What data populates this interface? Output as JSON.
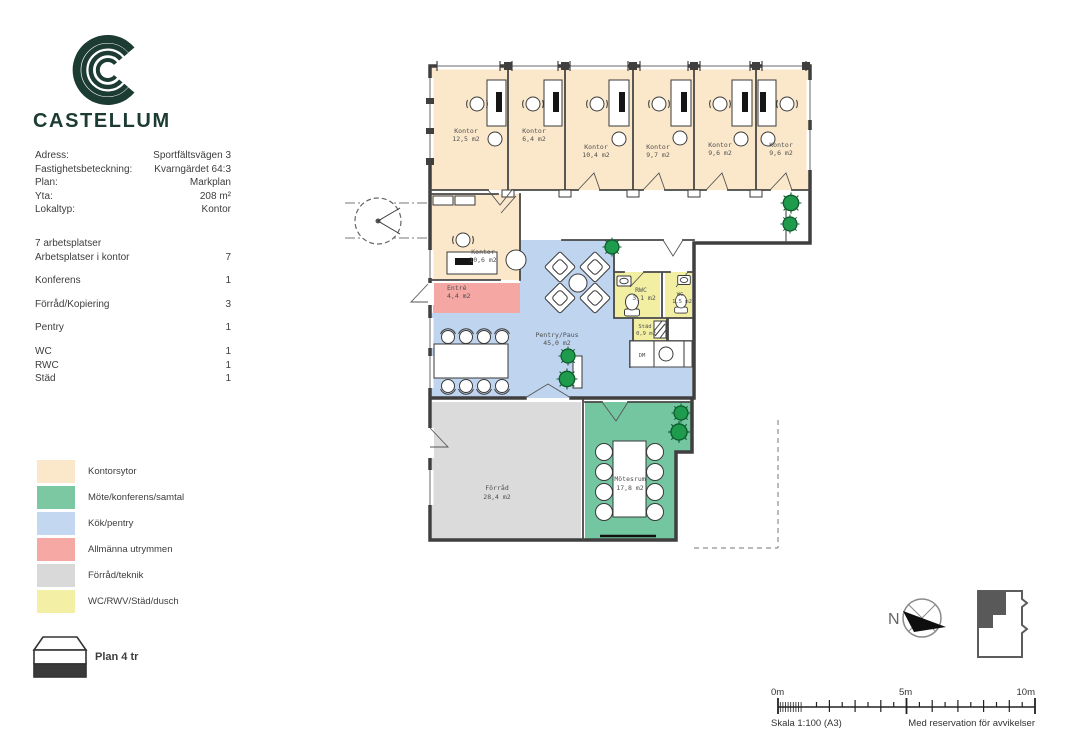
{
  "brand": {
    "wordmark": "CASTELLUM"
  },
  "info": {
    "rows": [
      {
        "label": "Adress:",
        "value": "Sportfältsvägen 3"
      },
      {
        "label": "Fastighetsbeteckning:",
        "value": "Kvarngärdet 64:3"
      },
      {
        "label": "Plan:",
        "value": "Markplan"
      },
      {
        "label": "Yta:",
        "value": "208 m²"
      },
      {
        "label": "Lokaltyp:",
        "value": "Kontor"
      },
      {
        "label": "7 arbetsplatser",
        "value": ""
      },
      {
        "label": "Arbetsplatser i kontor",
        "value": "7"
      },
      {
        "label": "Konferens",
        "value": "1"
      },
      {
        "label": "Förråd/Kopiering",
        "value": "3"
      },
      {
        "label": "Pentry",
        "value": "1"
      },
      {
        "label": "WC",
        "value": "1"
      },
      {
        "label": "RWC",
        "value": "1"
      },
      {
        "label": "Städ",
        "value": "1"
      }
    ]
  },
  "legend": {
    "items": [
      {
        "label": "Kontorsytor",
        "color": "#FBE8CB"
      },
      {
        "label": "Möte/konferens/samtal",
        "color": "#7CC8A3"
      },
      {
        "label": "Kök/pentry",
        "color": "#C3D7F0"
      },
      {
        "label": "Allmänna utrymmen",
        "color": "#F5A8A4"
      },
      {
        "label": "Förråd/teknik",
        "color": "#D9D9D9"
      },
      {
        "label": "WC/RWV/Städ/dusch",
        "color": "#F3F0A5"
      }
    ]
  },
  "plan_icon": {
    "label": "Plan 4 tr"
  },
  "plan": {
    "rooms": [
      {
        "name": "Kontor",
        "area": "12,5 m2"
      },
      {
        "name": "Kontor",
        "area": "6,4 m2"
      },
      {
        "name": "Kontor",
        "area": "10,4 m2"
      },
      {
        "name": "Kontor",
        "area": "9,7 m2"
      },
      {
        "name": "Kontor",
        "area": "9,6 m2"
      },
      {
        "name": "Kontor",
        "area": "9,6 m2"
      },
      {
        "name": "Kontor",
        "area": "10,6 m2"
      },
      {
        "name": "Entré",
        "area": "4,4 m2"
      },
      {
        "name": "Pentry/Paus",
        "area": "45,0 m2"
      },
      {
        "name": "RWC",
        "area": "3,1 m2"
      },
      {
        "name": "WC",
        "area": "1,5 m2"
      },
      {
        "name": "Städ",
        "area": "0,9 m2"
      },
      {
        "name": "Förråd",
        "area": "28,4 m2"
      },
      {
        "name": "Mötesrum",
        "area": "17,8 m2"
      }
    ],
    "misc": {
      "dm": "DM"
    }
  },
  "footer": {
    "north": "N",
    "scale_ticks": [
      "0m",
      "5m",
      "10m"
    ],
    "scale_text": "Skala 1:100 (A3)",
    "disclaimer": "Med reservation för avvikelser"
  },
  "colors": {
    "brand": "#1C3B33",
    "kontor": "#FBE8CB",
    "mote": "#74C6A1",
    "kok": "#BFD4EE",
    "allmanna": "#F4A7A3",
    "forrad": "#DBDBDB",
    "wc": "#F2EFA3"
  }
}
